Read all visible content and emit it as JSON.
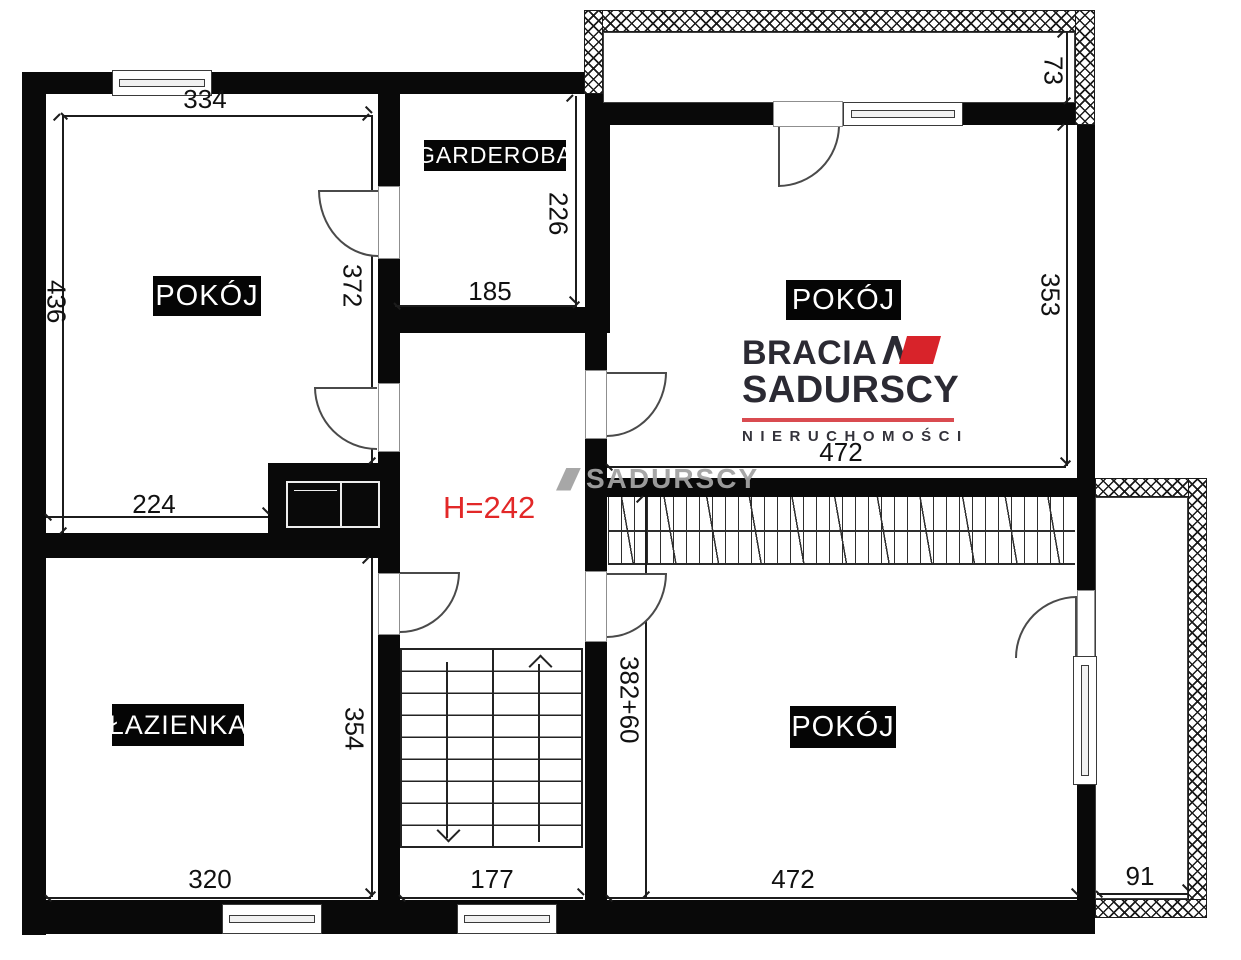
{
  "rooms": {
    "top_left": "POKÓJ",
    "top_right": "POKÓJ",
    "bottom_right": "POKÓJ",
    "bathroom": "ŁAZIENKA",
    "wardrobe": "GARDEROBA"
  },
  "height_note": "H=242",
  "dims": {
    "tl_top": "334",
    "tl_left": "436",
    "tl_right": "372",
    "tl_bottom": "224",
    "gard_right": "226",
    "gard_bottom": "185",
    "balcony_top_depth": "73",
    "tr_right": "353",
    "tr_width": "472",
    "bath_right": "354",
    "bath_bottom": "320",
    "stairs_width": "177",
    "br_left": "382+60",
    "br_bottom": "472",
    "balcony_right_width": "91"
  },
  "logo": {
    "brand_top": "BRACIA",
    "brand_bottom": "SADURSCY",
    "tagline": "NIERUCHOMOŚCI"
  },
  "watermark": "SADURSCY",
  "colors": {
    "height_note_red": "#e22828",
    "logo_dark": "#2b2a33",
    "logo_red": "#d8232a",
    "logo_rule_red": "#d94b50",
    "watermark_gray": "#a2a2a2",
    "wall_black": "#090909"
  }
}
